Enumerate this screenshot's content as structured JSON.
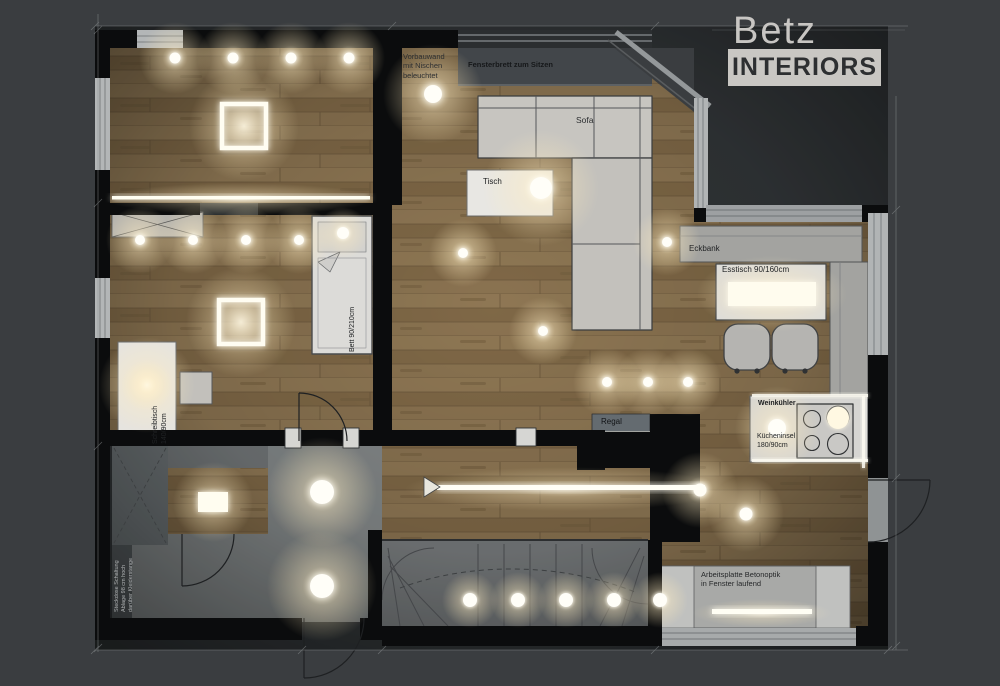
{
  "brand": {
    "name": "Betz",
    "wordmark": "INTERIORS"
  },
  "annotations": {
    "vorbauwand": "Vorbauwand\nmit Nischen\nbeleuchtet",
    "fensterbrett": "Fensterbrett zum Sitzen",
    "sofa": "Sofa",
    "tisch": "Tisch",
    "eckbank": "Eckbank",
    "esstisch": "Esstisch 90/160cm",
    "bett": "Bett 90/210cm",
    "schreibtisch": "Schreibtisch\n140/90cm",
    "regal": "Regal",
    "weinkuehler": "Weinkühler",
    "kuecheninsel": "Kücheninsel\n180/90cm",
    "arbeitsplatte": "Arbeitsplatte Betonoptik\nin Fenster laufend",
    "garderobe": "Steckdose Schaltung\nAblage 98 cm hoch\ndarüber Kleiderstange"
  },
  "colors": {
    "background": "#3a3d40",
    "wall": "#0b0c0d",
    "wood": "#a5875c",
    "floor_gray": "#9b9fa0",
    "light_warm": "#fff3d8",
    "logo_box": "#c9c7c3"
  }
}
